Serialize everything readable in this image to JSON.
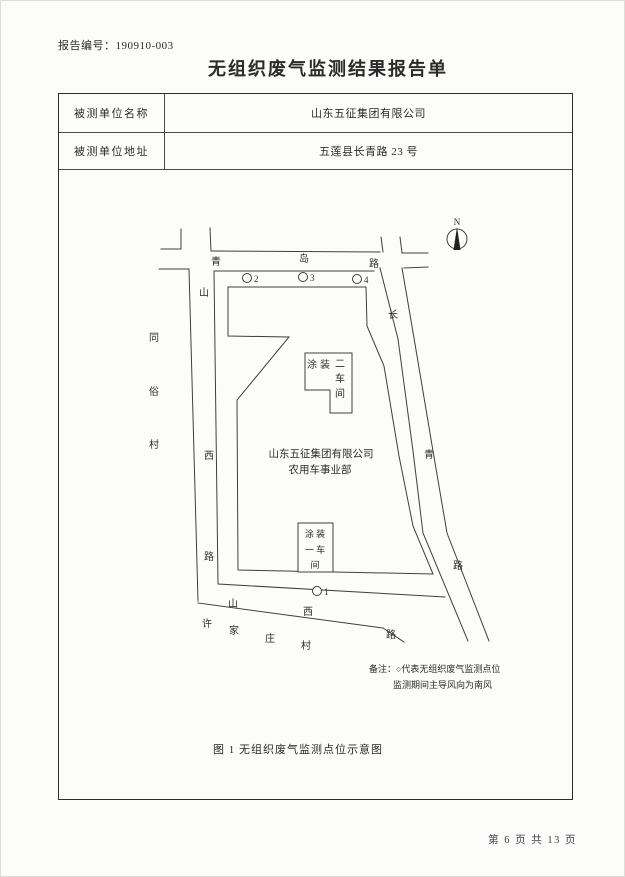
{
  "page": {
    "report_no": "报告编号：190910-003",
    "title": "无组织废气监测结果报告单",
    "footer": "第 6 页 共 13 页"
  },
  "table": {
    "rows": [
      {
        "label": "被测单位名称",
        "value": "山东五征集团有限公司"
      },
      {
        "label": "被测单位地址",
        "value": "五莲县长青路 23 号"
      }
    ]
  },
  "map": {
    "north_label": "N",
    "roads": {
      "qingdao": [
        "青",
        "岛",
        "路"
      ],
      "shanxi_west": [
        "山",
        "西",
        "路"
      ],
      "shanxi_south": [
        "山",
        "西",
        "路"
      ],
      "changqing": [
        "长",
        "青",
        "路"
      ]
    },
    "villages": {
      "tongsu": [
        "同",
        "俗",
        "村"
      ],
      "xujiazhuang": [
        "许",
        "家",
        "庄",
        "村"
      ]
    },
    "company": {
      "line1": "山东五征集团有限公司",
      "line2": "农用车事业部"
    },
    "buildings": {
      "workshop2": {
        "label_h": "涂装",
        "v1": "二",
        "v2": "车",
        "v3": "间"
      },
      "workshop1": {
        "r1": "涂 装",
        "r2": "一 车",
        "r3": "间"
      }
    },
    "points": [
      "2",
      "3",
      "4",
      "1"
    ],
    "remark_line1": "备注：○代表无组织废气监测点位",
    "remark_line2": "监测期间主导风向为南风",
    "caption": "图 1  无组织废气监测点位示意图"
  },
  "colors": {
    "ink": "#2b2b2b",
    "line": "#3f3f3f",
    "paper": "#fcfcfa"
  }
}
